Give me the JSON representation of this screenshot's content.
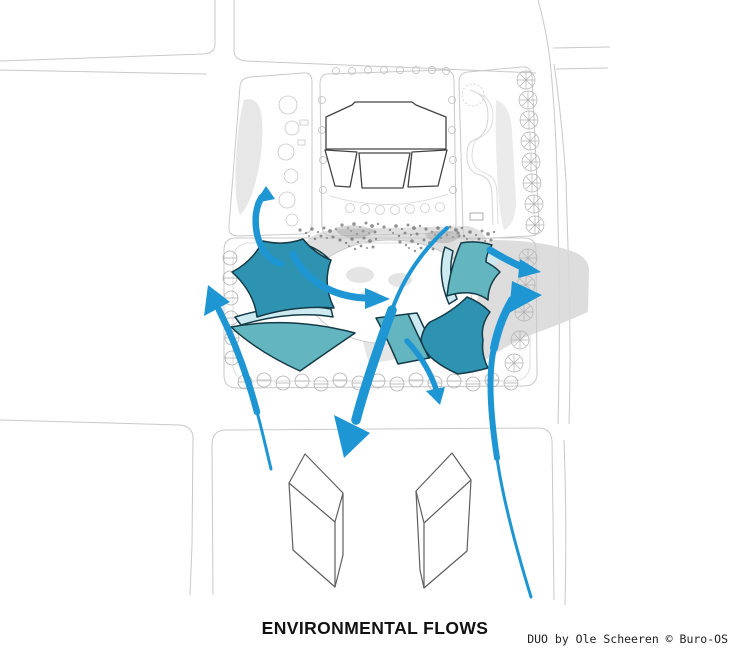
{
  "page": {
    "title": "ENVIRONMENTAL FLOWS",
    "credit": "DUO by Ole Scheeren © Buro-OS"
  },
  "colors": {
    "arrow_blue": "#1e96d4",
    "teal_dark": "#2e93b1",
    "teal_mid": "#63b6bf",
    "pale_cyan": "#cdeaf1",
    "outline_navy": "#143b47",
    "plan_line": "#c9c9c9",
    "plan_dark": "#434343",
    "shadow_gray": "#d9d9d9",
    "volume_line": "#5f5f5f"
  }
}
